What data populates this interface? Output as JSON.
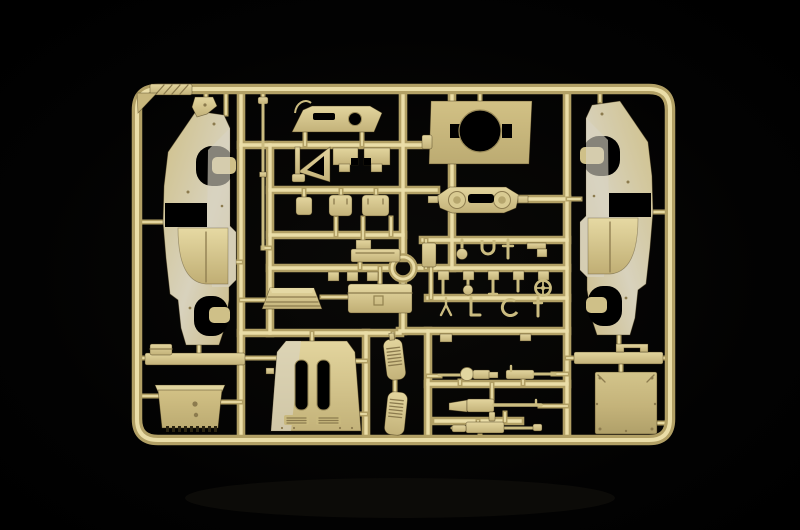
{
  "scene": {
    "description": "Studio product photograph of an injection-moulded model kit sprue: a rounded rectangular tree of tan styrene parts for a military vehicle model, lit softly against a pure black background",
    "object": "plastic model kit parts sprue",
    "material": "tan styrene plastic",
    "backdrop": "black studio backdrop"
  },
  "colors": {
    "background": "#010101",
    "floor_reflection": "#0d0c09",
    "plastic_light": "#eadda7",
    "plastic_mid": "#d6c68c",
    "plastic_dark": "#b2a065",
    "plastic_deep": "#8c7b4e",
    "plastic_sheen": "#d8d3c3",
    "plastic_olive": "#bfae74",
    "hole_shadow": "#000000"
  },
  "sprue": {
    "frame_shape": "rounded rectangle frame with internal runners",
    "parts": [
      {
        "name": "hull side panel left",
        "feature": "two wheel-arch cutouts and rectangular opening"
      },
      {
        "name": "hull side panel right",
        "feature": "mirror image of left panel"
      },
      {
        "name": "visor plate",
        "feature": "angled plate with round hole, slot and wire handle"
      },
      {
        "name": "turret roof plate",
        "feature": "large circular hatch opening with side notches"
      },
      {
        "name": "gun mount plate",
        "feature": "two round bosses and center slot"
      },
      {
        "name": "a-frame bracket"
      },
      {
        "name": "notched access plate left"
      },
      {
        "name": "notched access plate right"
      },
      {
        "name": "small hatch"
      },
      {
        "name": "hatch cover 1"
      },
      {
        "name": "hatch cover 2"
      },
      {
        "name": "gun barrel rod"
      },
      {
        "name": "ring sight"
      },
      {
        "name": "ribbed canopy roof"
      },
      {
        "name": "stowage box"
      },
      {
        "name": "engine hood",
        "feature": "two long slot openings and louver vents"
      },
      {
        "name": "louver grille 1"
      },
      {
        "name": "louver grille 2"
      },
      {
        "name": "toothed glacis plate"
      },
      {
        "name": "fender bar"
      },
      {
        "name": "machine gun with ball mount"
      },
      {
        "name": "machine gun"
      },
      {
        "name": "long machine gun 1"
      },
      {
        "name": "long machine gun 2"
      },
      {
        "name": "rear shelf bar"
      },
      {
        "name": "rear armour plate",
        "feature": "riveted rectangular plate"
      },
      {
        "name": "assorted small fittings",
        "feature": "pins, clamps, handwheel, hooks on runner rows"
      },
      {
        "name": "mould tag"
      }
    ]
  }
}
